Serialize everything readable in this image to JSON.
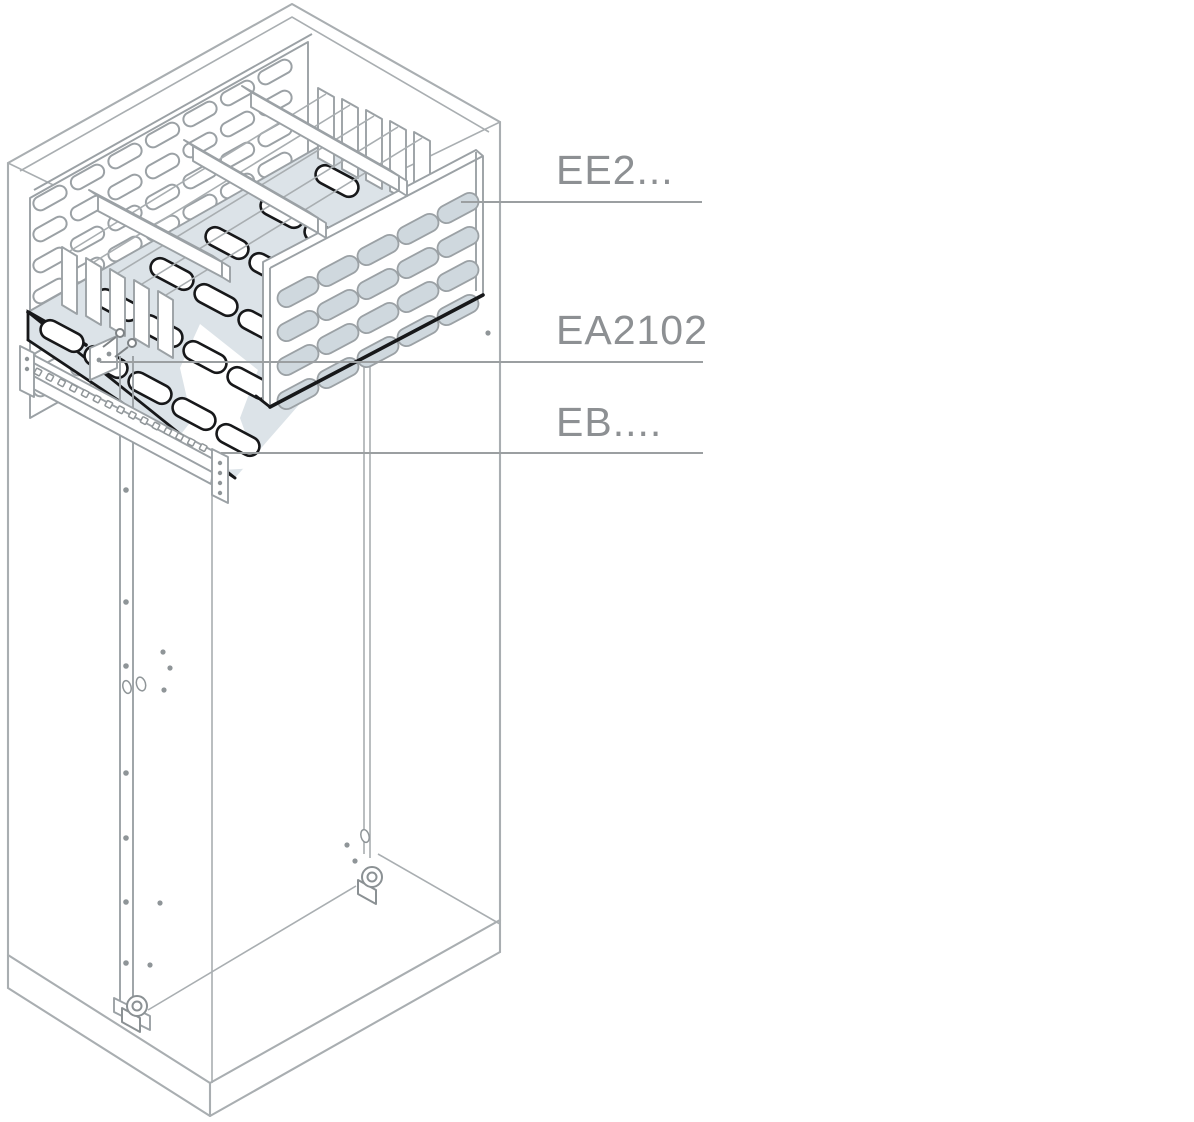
{
  "drawing": {
    "part_labels": [
      {
        "id": "ee2",
        "text": "EE2..."
      },
      {
        "id": "ea2102",
        "text": "EA2102"
      },
      {
        "id": "eb",
        "text": "EB...."
      }
    ]
  },
  "colors": {
    "background": "#ffffff",
    "frame_line": "#a9aeb1",
    "part_line": "#9ba1a5",
    "highlight_line": "#17181a",
    "panel_fill": "#dce3e8",
    "slot_fill": "#cfd8de",
    "label_text": "#8d9093",
    "leader_line": "#9b9fa1"
  }
}
